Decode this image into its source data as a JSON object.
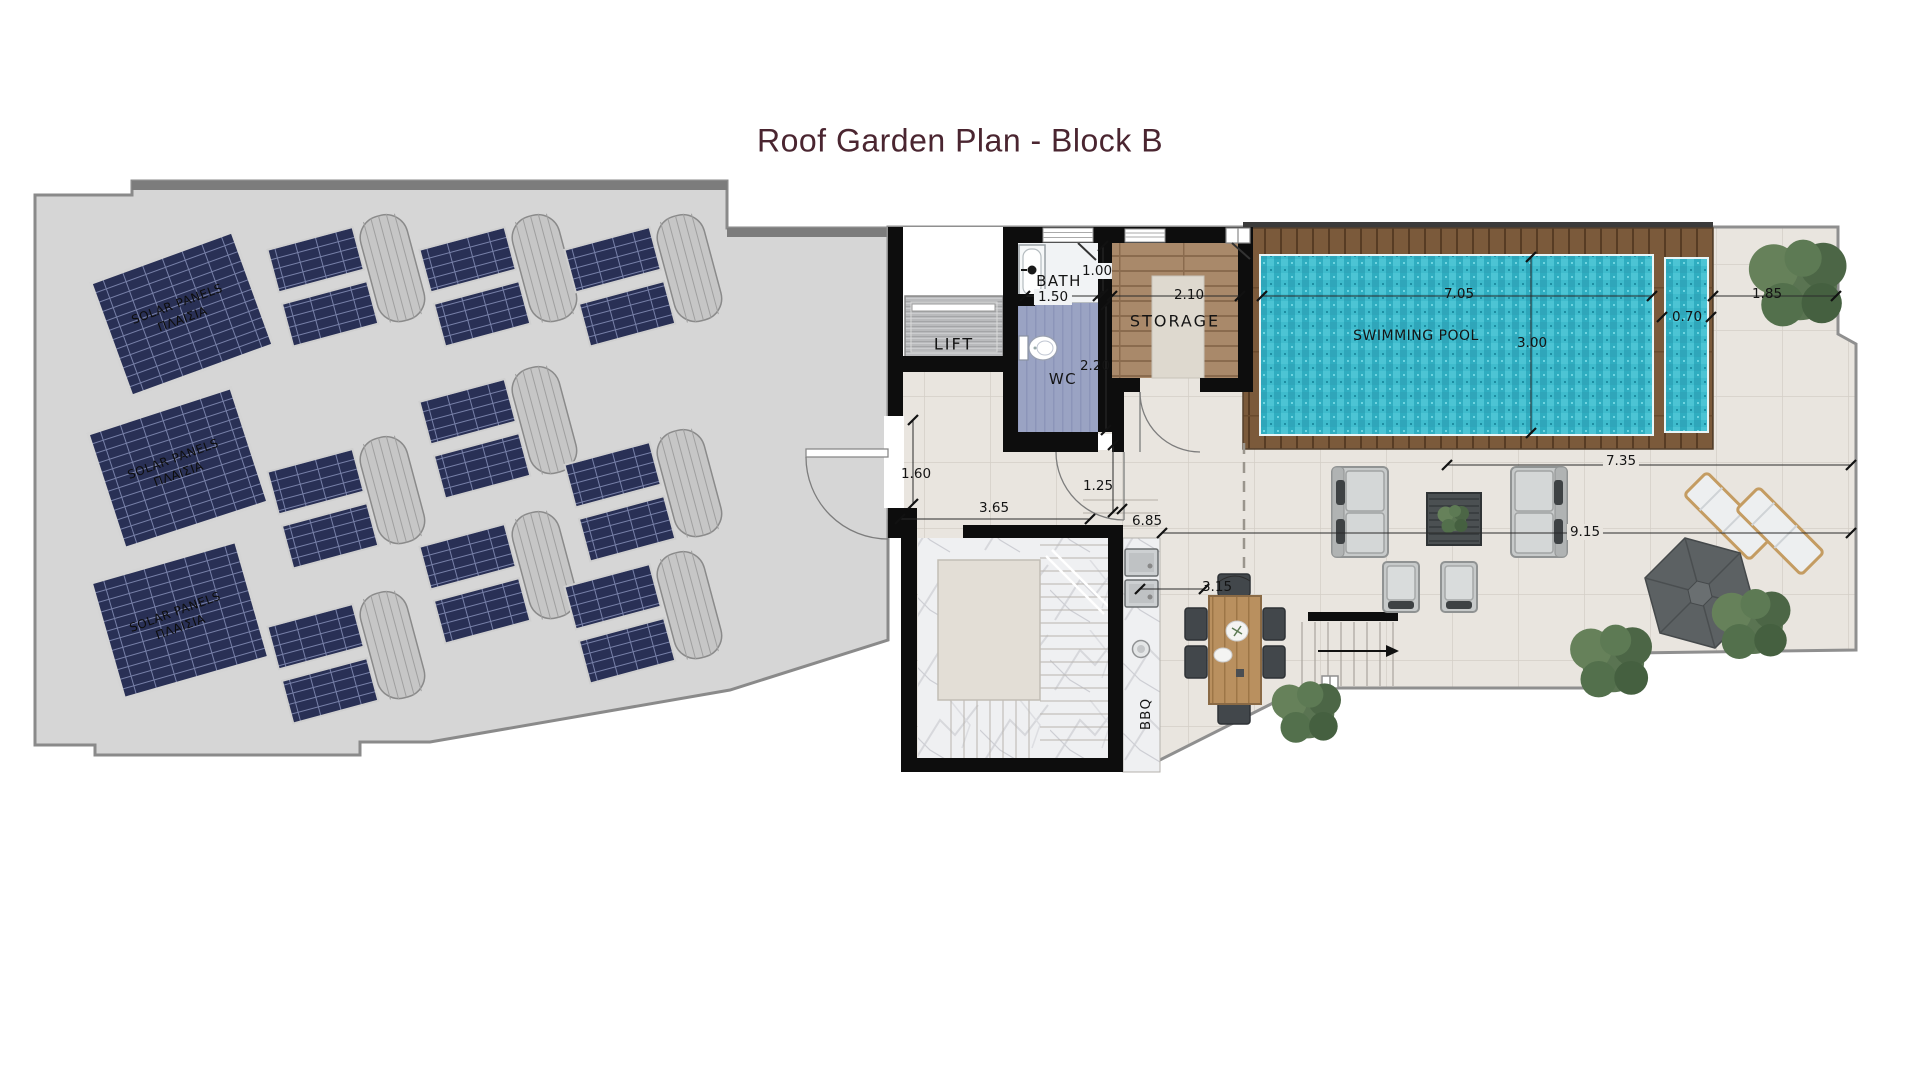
{
  "title": "Roof Garden Plan - Block B",
  "rooms": {
    "lift": "LIFT",
    "bath": "BATH",
    "wc": "WC",
    "storage": "STORAGE",
    "swimming_pool": "SWIMMING POOL",
    "bbq": "BBQ"
  },
  "solar_panels": {
    "line1": "SOLAR PANELS",
    "line2": "ΠΛΑΙΣΙΑ"
  },
  "dimensions": {
    "bath_width": "1.00",
    "bath_length": "1.50",
    "wc_length": "2.20",
    "storage_width": "2.10",
    "pool_length": "7.05",
    "pool_width": "3.00",
    "pool_strip_width": "0.70",
    "side_terrace": "1.85",
    "roof_door": "1.60",
    "hall_width": "3.65",
    "hall_door": "1.25",
    "terrace_a": "6.85",
    "dining_width": "3.15",
    "terrace_b": "7.35",
    "terrace_c": "9.15"
  },
  "colors": {
    "title_accent": "#4A2530",
    "pool_water": "#38B5C8",
    "solar_panel": "#293055",
    "deck_wood": "#7B5A3B",
    "roof_gray": "#D6D6D6",
    "terrace_tile": "#E9E5DF",
    "wall": "#0D0D0D"
  }
}
